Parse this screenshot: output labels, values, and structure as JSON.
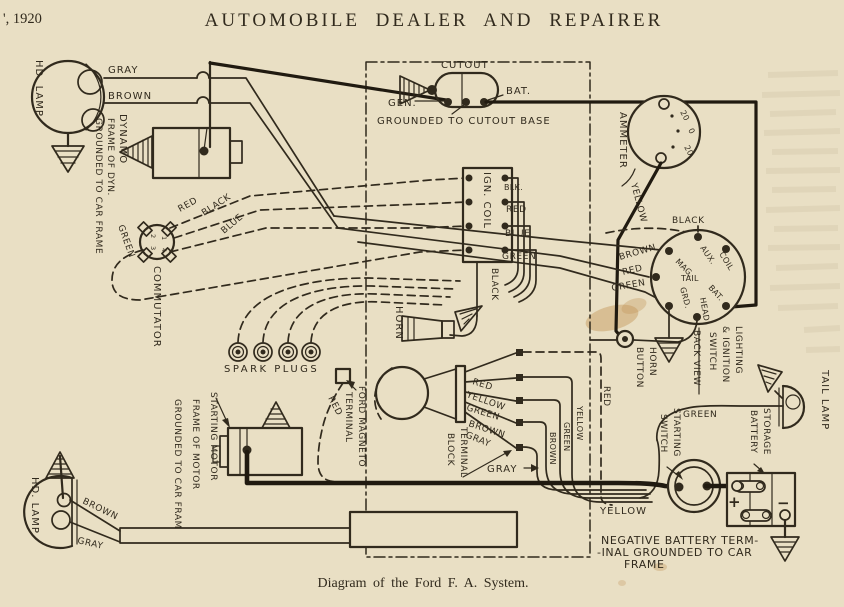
{
  "page": {
    "header_left": "', 1920",
    "title": "AUTOMOBILE DEALER AND REPAIRER",
    "caption": "Diagram of the Ford F. A. System."
  },
  "colors": {
    "paper": "#e9dfc4",
    "ink": "#312a1d",
    "heavy": "#201a10",
    "stain": "#c49659"
  },
  "labels": {
    "hd_lamp_top": "HD. LAMP",
    "gray_top": "GRAY",
    "brown_top": "BROWN",
    "dynamo": "DYNAMO",
    "dynamo_frame": "FRAME OF DYN.",
    "dynamo_grounded": "GROUNDED TO CAR FRAME",
    "red_comm": "RED",
    "black_comm": "BLACK",
    "blue_comm": "BLUE",
    "green_comm": "GREEN",
    "commutator": "COMMUTATOR",
    "comm_1": "1",
    "comm_2": "2",
    "comm_3": "3",
    "comm_4": "4",
    "spark_plugs": "SPARK PLUGS",
    "cutout": "CUTOUT",
    "bat_cutout": "BAT.",
    "gen_cutout": "GEN.",
    "grounded_cutout": "GROUNDED TO CUTOUT BASE",
    "ammeter": "AMMETER",
    "amm_20a": "20",
    "amm_0": "0",
    "amm_20b": "20",
    "yellow_ammeter": "YELLOW",
    "ign_coil": "IGN. COIL",
    "blk_coil": "BLK.",
    "red_coil": "RED",
    "blue_coil": "BLUE",
    "green_coil": "GREEN",
    "black_coil_down": "BLACK",
    "horn": "HORN",
    "black_switch": "BLACK",
    "brown_switch": "BROWN",
    "red_switch": "RED",
    "green_switch": "GREEN",
    "sw_aux": "AUX.",
    "sw_mag": "MAG.",
    "sw_coil": "COIL",
    "sw_tail": "TAIL",
    "sw_bat": "BAT.",
    "sw_head": "HEAD",
    "sw_grd": "GRD.",
    "horn_button_l1": "HORN",
    "horn_button_l2": "BUTTON",
    "switch_l1": "LIGHTING",
    "switch_l2": "& IGNITION",
    "switch_l3": "SWITCH",
    "switch_l4": "BACK VIEW",
    "ford_magneto_l1": "FORD MAGNETO",
    "ford_magneto_l2": "TERMINAL",
    "red_magneto": "RED",
    "starting_motor_l1": "STARTING MOTOR",
    "starting_motor_l2": "FRAME OF MOTOR",
    "starting_motor_l3": "GROUNDED TO CAR FRAME",
    "tb_red": "RED",
    "tb_yellow": "YELLOW",
    "tb_green": "GREEN",
    "tb_brown": "BROWN",
    "tb_gray": "GRAY",
    "terminal_block_l1": "TERMINAL",
    "terminal_block_l2": "BLOCK",
    "gray_pointer": "GRAY",
    "brown_v": "BROWN",
    "green_v": "GREEN",
    "yellow_v": "YELLOW",
    "red_v": "RED",
    "starting_switch_l1": "STARTING",
    "starting_switch_l2": "SWITCH",
    "green_tail": "GREEN",
    "storage_battery_l1": "STORAGE",
    "storage_battery_l2": "BATTERY",
    "tail_lamp": "TAIL LAMP",
    "yellow_bottom": "YELLOW",
    "neg_l1": "NEGATIVE BATTERY TERM-",
    "neg_l2": "-INAL GROUNDED TO CAR",
    "neg_l3": "FRAME",
    "hd_lamp_bottom": "HD. LAMP",
    "brown_bottom": "BROWN",
    "gray_bottom": "GRAY",
    "plus": "+",
    "minus": "−"
  }
}
